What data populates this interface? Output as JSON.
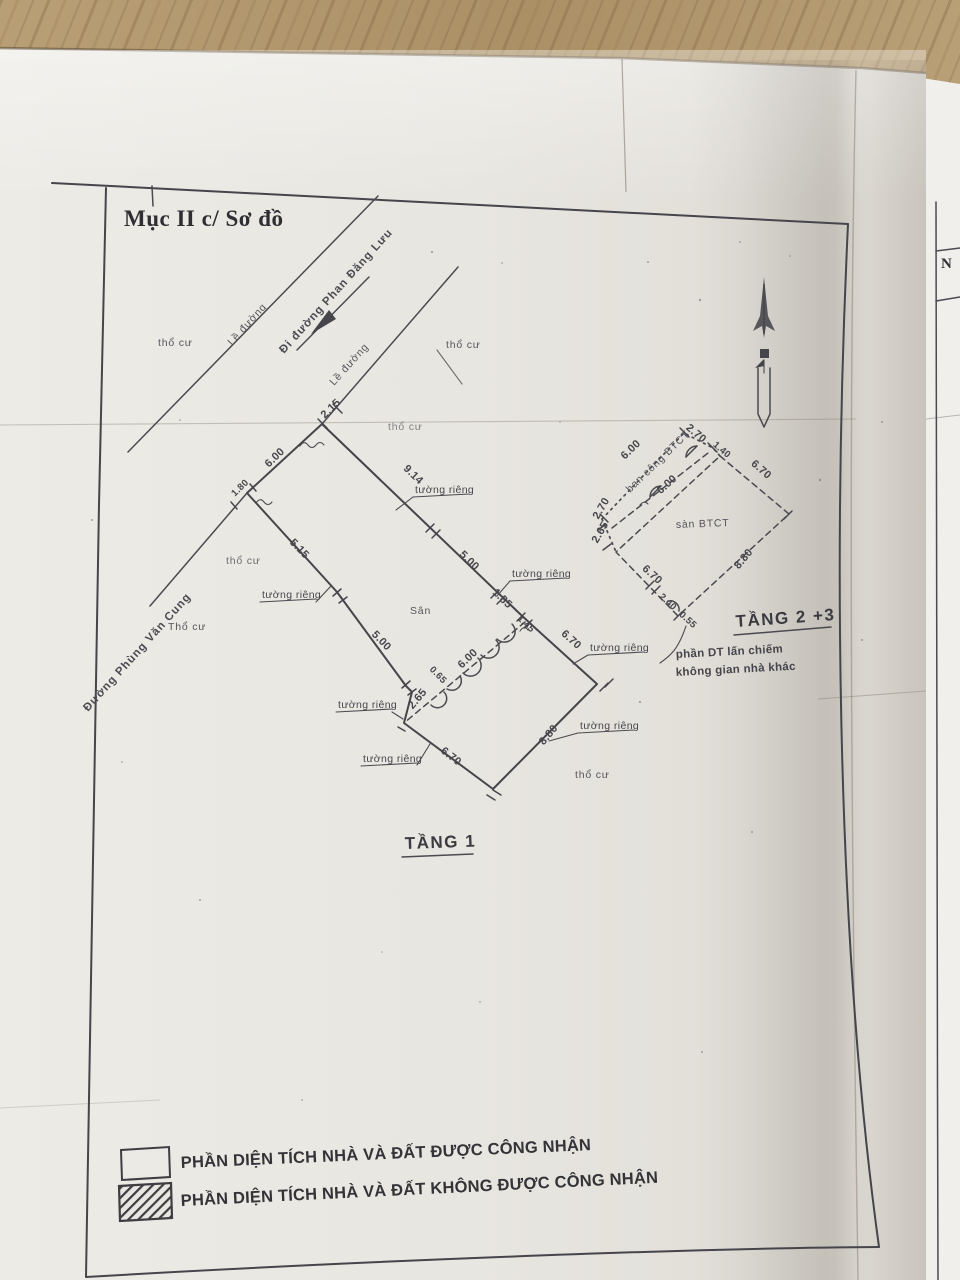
{
  "title": "Mục II c/ Sơ đồ",
  "streets": {
    "phung_van_cung": "Đường Phùng Văn Cung",
    "phan_dang_luu_arrow": "Đi đường Phan Đăng Lưu",
    "sidewalk": "Lề đường"
  },
  "zones": {
    "tho_cu": "thổ cư",
    "tho_cu_cap": "Thổ cư",
    "san": "Sân",
    "shared_wall": "tường riêng"
  },
  "floor1": {
    "title": "TẦNG 1",
    "dims": {
      "street_gap": "2.15",
      "front": "6.00",
      "front_side": "1.80",
      "ne_a": "9.14",
      "ne_b": "5.00",
      "ne_c": "1.85",
      "step": "1.45",
      "sw_a": "5.15",
      "sw_b": "5.00",
      "sw_jog": "0.65",
      "sw_step": "2.65",
      "house_ne": "6.70",
      "house_se": "8.80",
      "house_sw": "6.70",
      "house_nw": "6.00"
    }
  },
  "floor23": {
    "title": "TẦNG 2 +3",
    "slab": "sàn BTCT",
    "balcony": "ban công BTCT",
    "note_line1": "phần DT lấn chiếm",
    "note_line2": "không gian nhà khác",
    "dims": {
      "balcony_front": "6.00",
      "balcony_end": "2.70",
      "corner": "1.40",
      "inner": "6.00",
      "nw_a": "2.70",
      "nw_b": "2.65",
      "ne": "6.70",
      "se": "8.80",
      "sw": "6.70",
      "notch_a": "2.40",
      "notch_b": "0.55"
    }
  },
  "legend": {
    "recognized": "PHẦN DIỆN TÍCH NHÀ VÀ ĐẤT ĐƯỢC CÔNG NHẬN",
    "not_recognized": "PHẦN DIỆN TÍCH NHÀ VÀ ĐẤT KHÔNG ĐƯỢC CÔNG NHẬN"
  },
  "side_sheet": {
    "label": "N"
  },
  "colors": {
    "paper": "#e9e6e0",
    "ink": "#45454b",
    "wood": "#b49b71"
  }
}
